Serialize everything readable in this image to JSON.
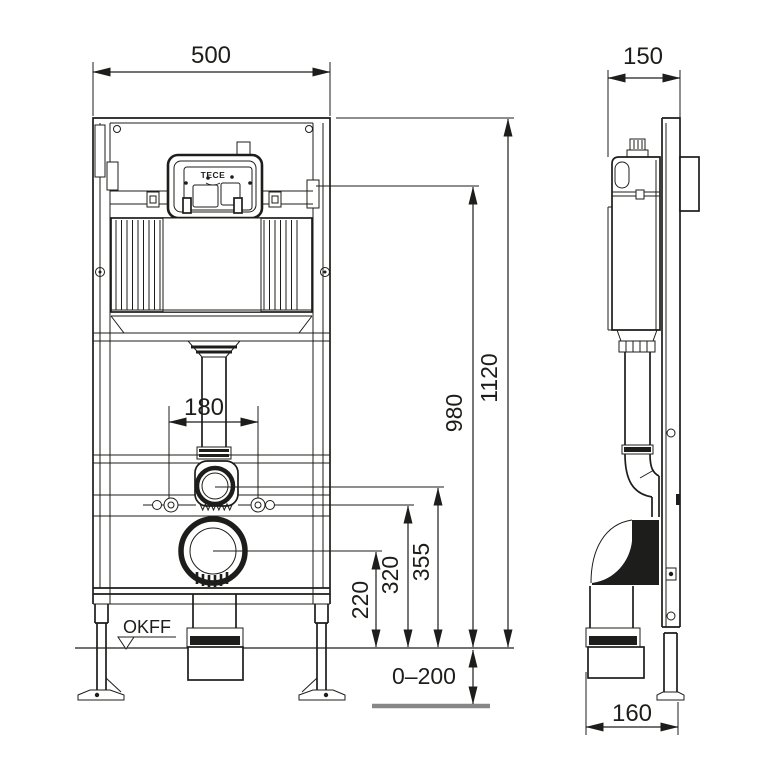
{
  "dimensions": {
    "frame_width": "500",
    "frame_depth": "150",
    "frame_height": "1120",
    "actuation_height": "980",
    "fixing_bolt_spacing": "180",
    "flush_connector_height": "355",
    "fixing_bolt_height": "320",
    "waste_outlet_height": "220",
    "floor_buildup_range": "0–200",
    "waste_outlet_offset": "160"
  },
  "labels": {
    "floor_level": "OKFF",
    "brand": "TECE"
  },
  "colors": {
    "line": "#1d1d1b",
    "raw_floor": "#878787",
    "background": "#ffffff"
  }
}
